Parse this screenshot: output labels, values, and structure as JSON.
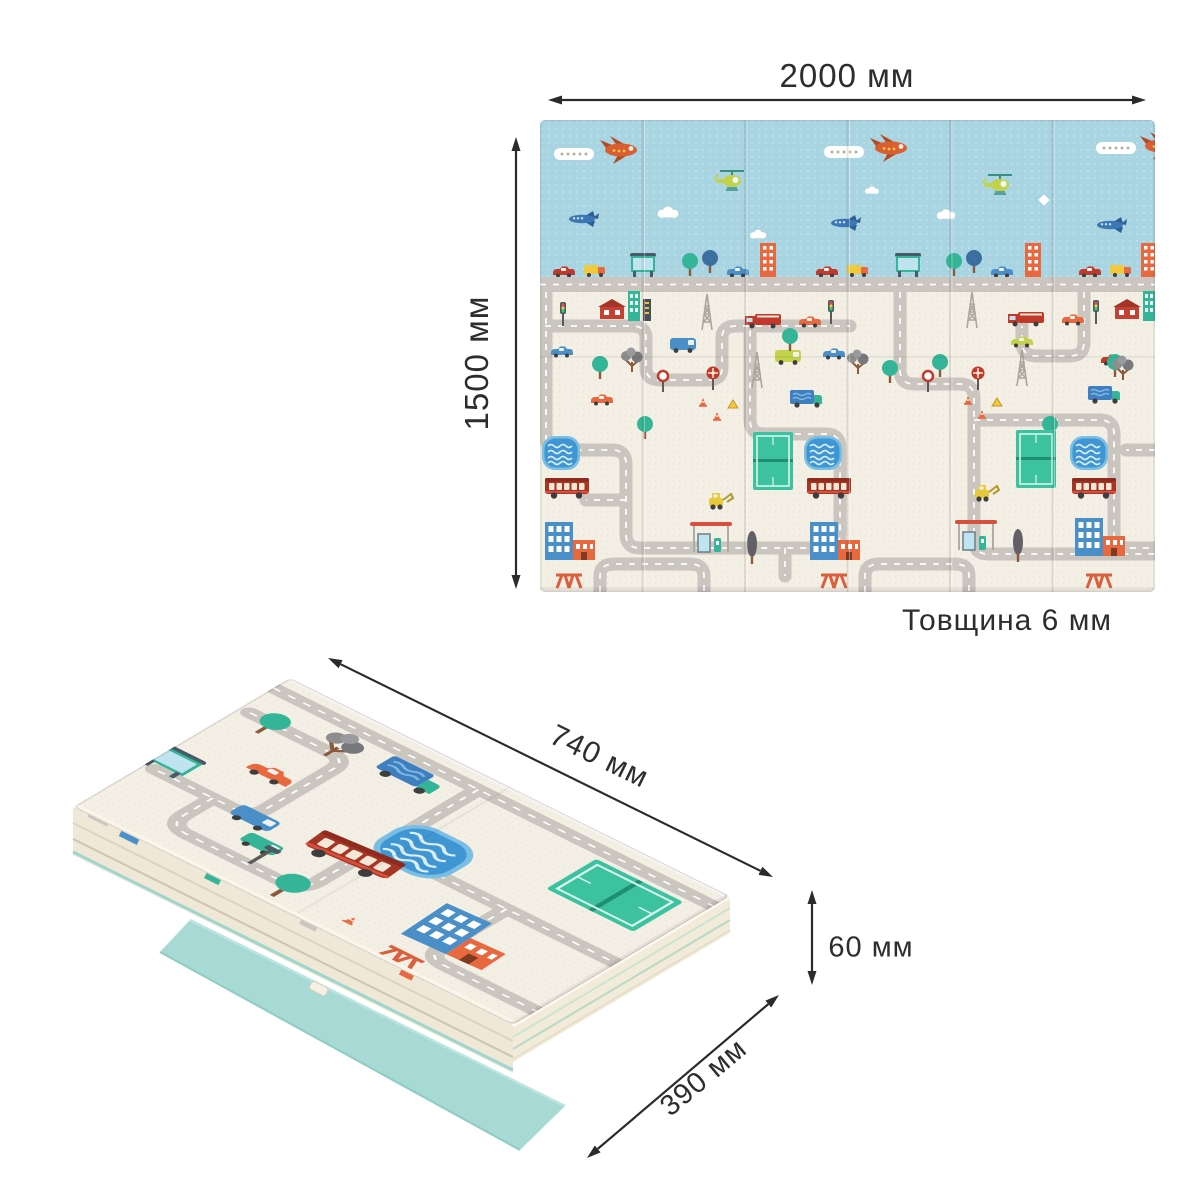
{
  "figure": {
    "flat_mat": {
      "width_label": "2000 мм",
      "height_label": "1500 мм",
      "thickness_label": "Товщина 6 мм"
    },
    "folded_mat": {
      "length_label": "740 мм",
      "depth_label": "390 мм",
      "height_label": "60 мм"
    },
    "colors": {
      "background": "#ffffff",
      "dimension_line": "#2b2b2b",
      "sky_blue": "#a9d4e2",
      "mat_cream": "#f3efe5",
      "road_gray": "#cac5bf",
      "teal_backing": "#a7dad4",
      "accent_red": "#c0392b",
      "accent_orange": "#e8683f",
      "accent_teal": "#35b597",
      "accent_blue": "#4a8fc7",
      "pool_blue": "#3f96d2",
      "court_green": "#3cc29e"
    }
  }
}
